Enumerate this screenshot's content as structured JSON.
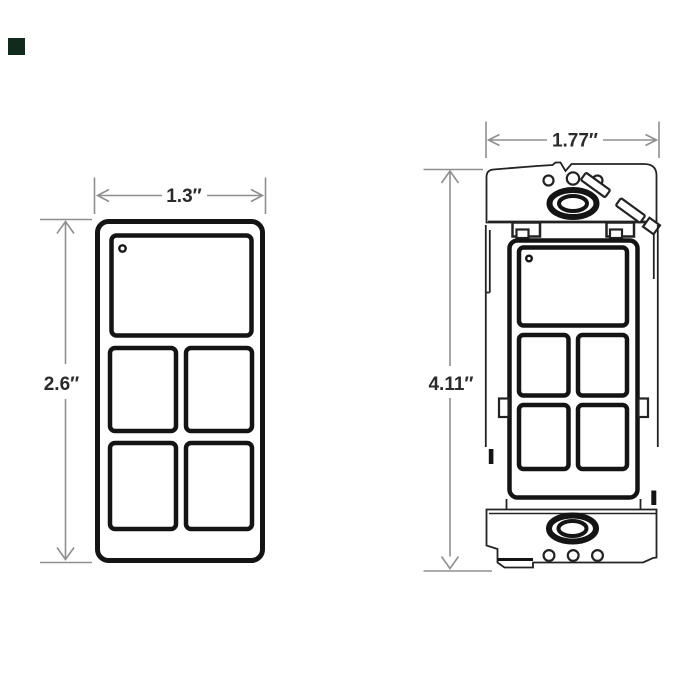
{
  "page": {
    "background": "#ffffff"
  },
  "corner_marker": {
    "color": "#122a1c"
  },
  "style": {
    "drawing_line_color": "#141414",
    "bracket_line_color": "#232323",
    "dimension_line_color": "#8f8f8f",
    "label_color": "#2b2b2b"
  },
  "front_view": {
    "width_label": "1.3″",
    "height_label": "2.6″"
  },
  "mounted_view": {
    "width_label": "1.77″",
    "height_label": "4.11″"
  }
}
